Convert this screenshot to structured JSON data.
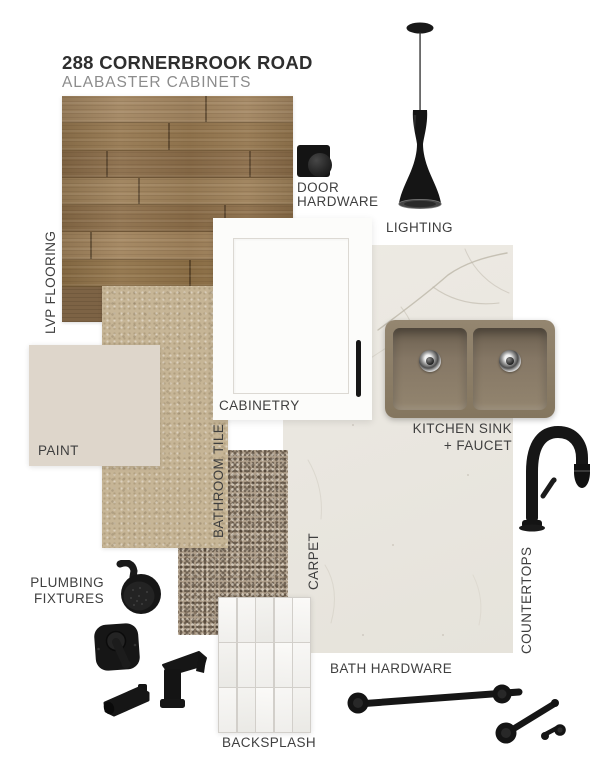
{
  "header": {
    "title": "288 CORNERBROOK ROAD",
    "subtitle": "ALABASTER CABINETS"
  },
  "labels": {
    "lvp_flooring": "LVP FLOORING",
    "door_hardware": [
      "DOOR",
      "HARDWARE"
    ],
    "lighting": "LIGHTING",
    "cabinetry": "CABINETRY",
    "paint": "PAINT",
    "bathroom_tile": "BATHROOM TILE",
    "kitchen_sink": [
      "KITCHEN SINK",
      "+ FAUCET"
    ],
    "carpet": "CARPET",
    "countertops": "COUNTERTOPS",
    "plumbing_fixtures": [
      "PLUMBING",
      "FIXTURES"
    ],
    "bath_hardware": "BATH HARDWARE",
    "backsplash": "BACKSPLASH"
  },
  "colors": {
    "background": "#ffffff",
    "title_text": "#2e2e2e",
    "subtitle_text": "#8c8c8c",
    "label_text": "#3f3f3f",
    "wood_light": "#a28560",
    "wood_mid": "#95774f",
    "wood_dark": "#7d6345",
    "paint_swatch": "#ded6cb",
    "bathroom_tile": "#c6b596",
    "carpet": "#b0a08c",
    "countertop": "#e9e6df",
    "marble_vein": "#bdb6a9",
    "cabinet_white": "#fcfcfa",
    "sink_truffle": "#8d7f6c",
    "fixture_black": "#161616",
    "backsplash_tile": "#f5f4f2",
    "grout": "#d2cfca"
  }
}
